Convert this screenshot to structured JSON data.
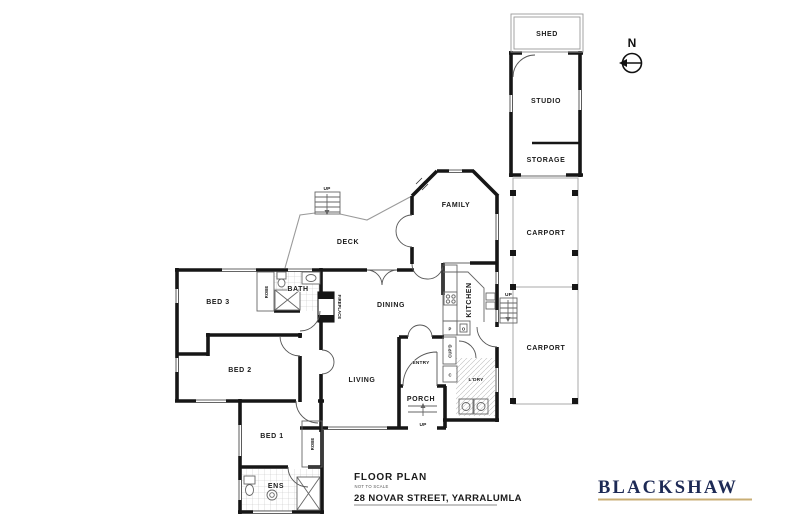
{
  "plan": {
    "north_label": "N",
    "outbuilding": {
      "shed": "SHED",
      "studio": "STUDIO",
      "storage": "STORAGE"
    },
    "carports": {
      "upper": "CARPORT",
      "lower": "CARPORT"
    },
    "rooms": {
      "family": "FAMILY",
      "deck": "DECK",
      "dining": "DINING",
      "kitchen": "KITCHEN",
      "living": "LIVING",
      "entry": "ENTRY",
      "porch": "PORCH",
      "laundry": "L'DRY",
      "bath": "BATH",
      "bed1": "BED 1",
      "bed2": "BED 2",
      "bed3": "BED 3",
      "ensuite": "ENS"
    },
    "fixtures": {
      "robe_bed3": "ROBE",
      "robe_bed1": "ROBE",
      "fireplace": "FIREPLACE",
      "cupboard": "CUP'D",
      "pantry": "P",
      "oven": "O",
      "cupboard_c": "C"
    },
    "stairs": {
      "deck": "UP",
      "rear": "UP",
      "porch": "UP"
    }
  },
  "title_block": {
    "title": "FLOOR PLAN",
    "scale_note": "NOT TO SCALE",
    "address": "28 NOVAR STREET, YARRALUMLA"
  },
  "brand": {
    "name": "BLACKSHAW",
    "text_color": "#1d2a55",
    "rule_color": "#c9ae74"
  },
  "colors": {
    "walls": "#161616",
    "thin_lines": "#666666",
    "deck_outline": "#9a9a9a",
    "background": "#ffffff"
  }
}
